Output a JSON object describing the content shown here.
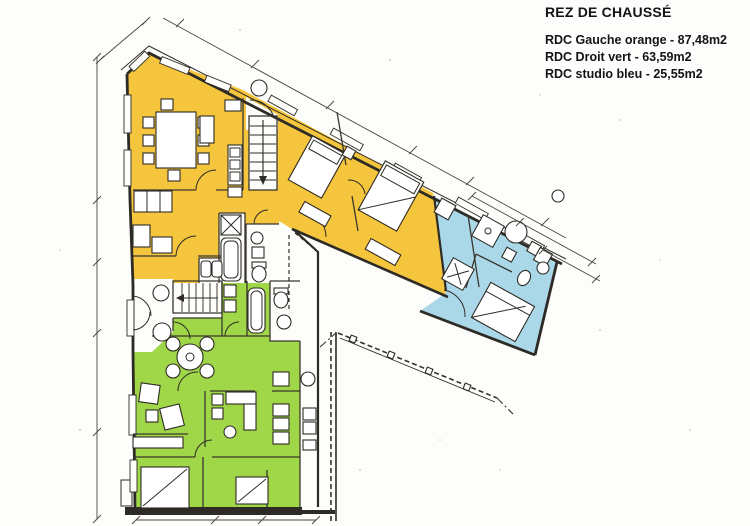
{
  "header": {
    "title": "REZ DE CHAUSSÉ"
  },
  "legend": {
    "items": [
      {
        "label": "RDC Gauche orange - 87,48m2",
        "color": "#f4c53d"
      },
      {
        "label": "RDC Droit vert - 63,59m2",
        "color": "#a0d748"
      },
      {
        "label": "RDC studio bleu - 25,55m2",
        "color": "#aad8e8"
      }
    ]
  },
  "zones": {
    "orange": {
      "name": "RDC Gauche orange",
      "area": "87,48m2",
      "color": "#f4c53d"
    },
    "vert": {
      "name": "RDC Droit vert",
      "area": "63,59m2",
      "color": "#a0d748"
    },
    "bleu": {
      "name": "RDC studio bleu",
      "area": "25,55m2",
      "color": "#aad8e8"
    }
  },
  "drawing": {
    "floor": "rez-de-chaussée",
    "wall_color": "#2e2b26",
    "paper_color": "#fdfdfb"
  }
}
